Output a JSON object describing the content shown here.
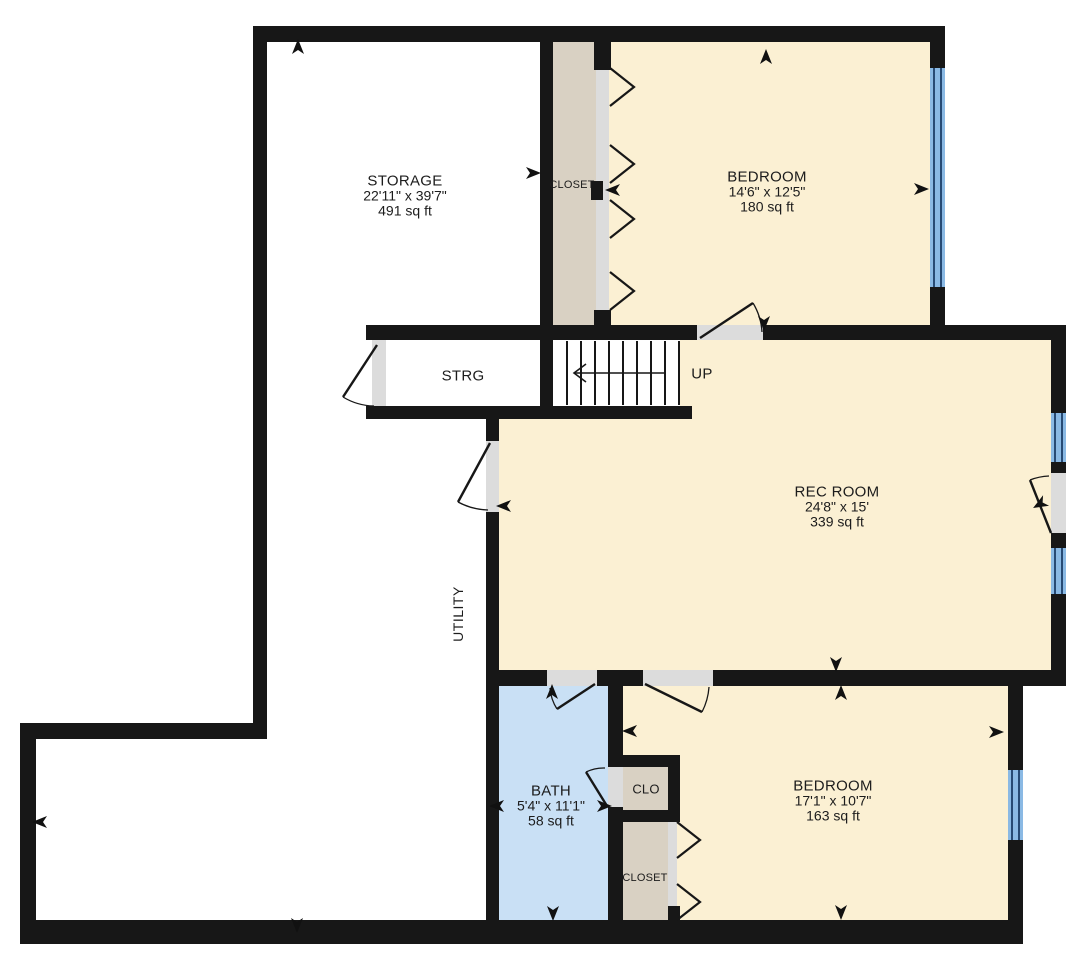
{
  "plan_type": "floor-plan",
  "colors": {
    "wall": "#171717",
    "room_fill": "#fbf0d3",
    "closet_fill": "#d9d1c3",
    "bath_fill": "#c9e0f5",
    "window_glass": "#8ab9e4",
    "window_frame": "#274a74",
    "door_opening": "#dcdcdc"
  },
  "rooms": {
    "storage": {
      "name": "STORAGE",
      "dims": "22'11\" x 39'7\"",
      "area": "491 sq ft"
    },
    "closet_upper": {
      "name": "CLOSET"
    },
    "bedroom_upper": {
      "name": "BEDROOM",
      "dims": "14'6\" x 12'5\"",
      "area": "180 sq ft"
    },
    "strg": {
      "name": "STRG"
    },
    "stairs": {
      "label": "UP"
    },
    "rec_room": {
      "name": "REC ROOM",
      "dims": "24'8\" x 15'",
      "area": "339 sq ft"
    },
    "utility": {
      "name": "UTILITY"
    },
    "bath": {
      "name": "BATH",
      "dims": "5'4\" x 11'1\"",
      "area": "58 sq ft"
    },
    "clo": {
      "name": "CLO"
    },
    "closet_lower": {
      "name": "CLOSET"
    },
    "bedroom_lower": {
      "name": "BEDROOM",
      "dims": "17'1\" x 10'7\"",
      "area": "163 sq ft"
    }
  }
}
